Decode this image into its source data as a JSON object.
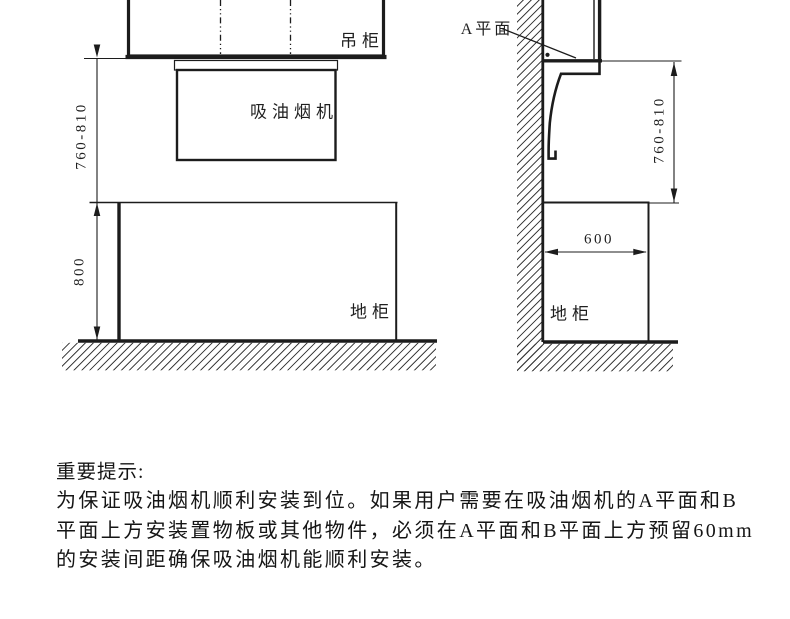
{
  "colors": {
    "ink": "#1c1c1c",
    "hatch": "#2b2b2b",
    "background": "#ffffff"
  },
  "front_view": {
    "wall_cabinet_label": "吊柜",
    "hood_label": "吸油烟机",
    "base_cabinet_label": "地柜",
    "hood_height_dim": "760-810",
    "base_height_dim": "800"
  },
  "side_view": {
    "a_plane_label": "A平面",
    "hood_height_dim": "760-810",
    "base_depth_dim": "600",
    "base_cabinet_label": "地柜"
  },
  "notice": {
    "title": "重要提示:",
    "lines": [
      "为保证吸油烟机顺利安装到位。如果用户需要在吸油烟机的A平面和B",
      "平面上方安装置物板或其他物件，必须在A平面和B平面上方预留60mm",
      "的安装间距确保吸油烟机能顺利安装。"
    ]
  }
}
